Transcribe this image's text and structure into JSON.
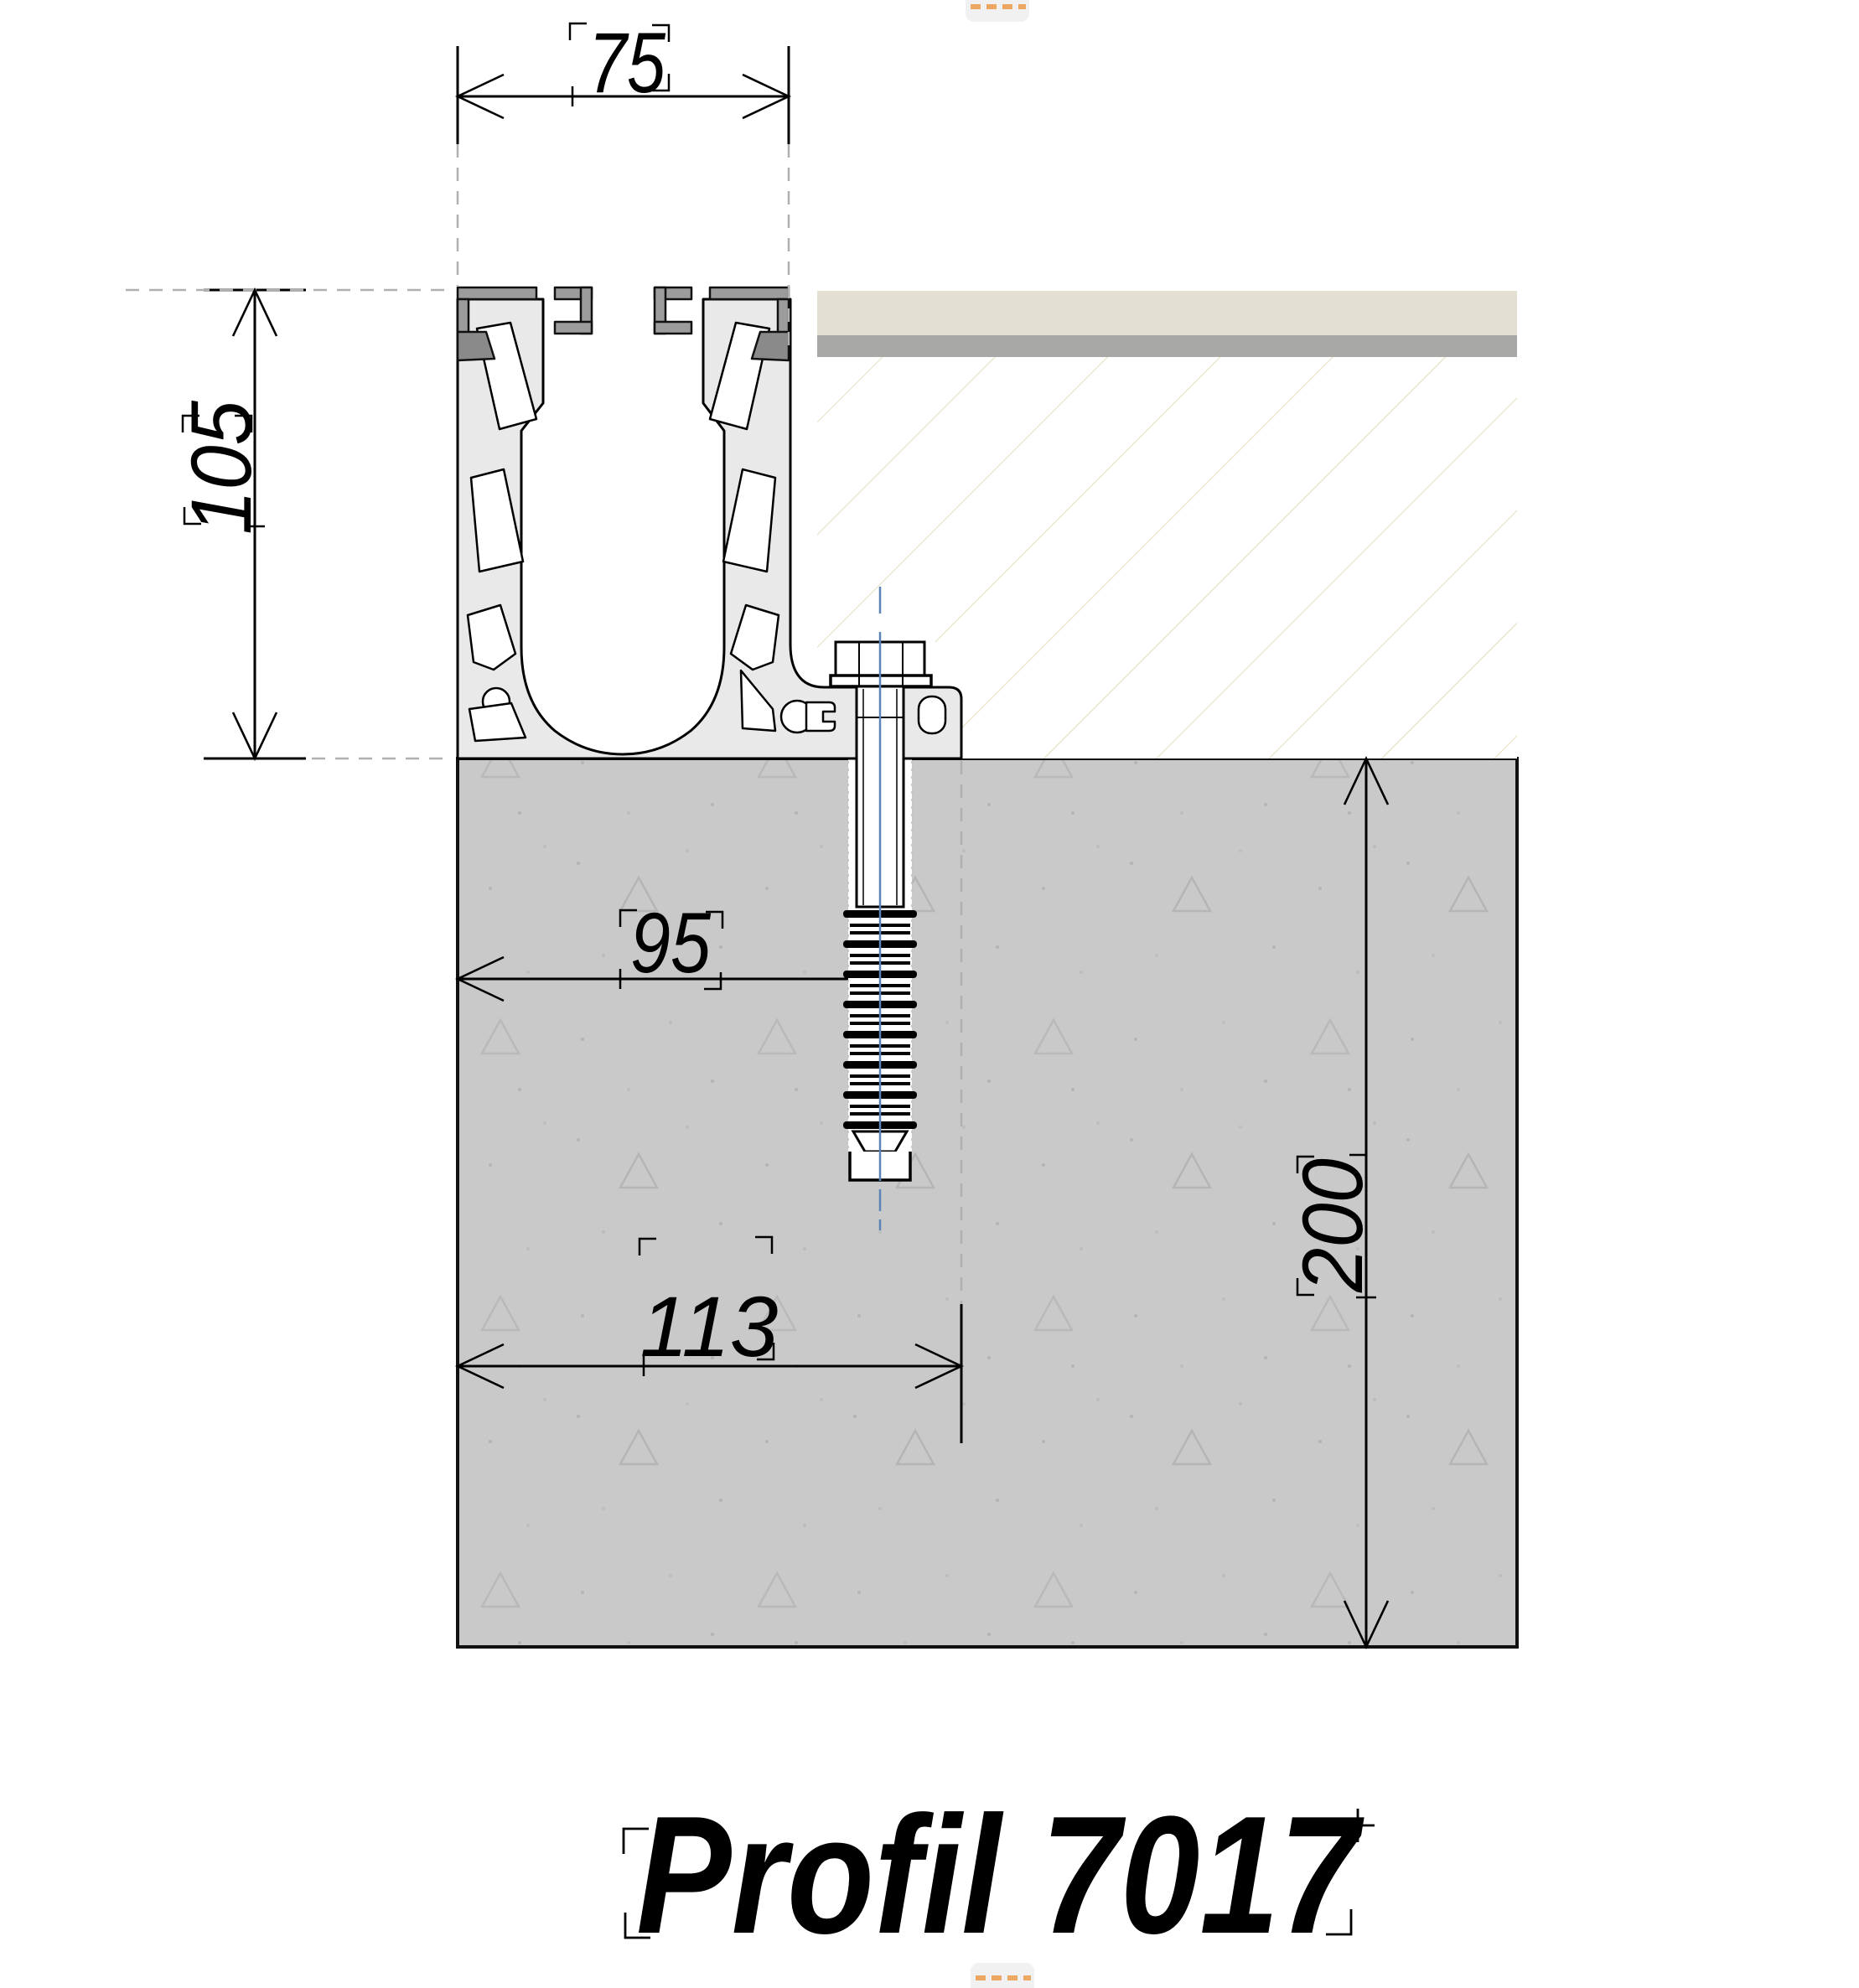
{
  "title": {
    "label": "Profil 7017"
  },
  "dims": {
    "top_width": "75",
    "profile_height": "105",
    "anchor_offset": "95",
    "base_width": "113",
    "embed_depth": "200"
  },
  "handles": {
    "top": "orange-dashed-drag-handle",
    "bottom": "orange-dashed-drag-handle"
  },
  "colors": {
    "concrete": "#c9c9c9",
    "slab_finish": "#e4dfd3",
    "slab_screed": "#a8a8a6",
    "hatch_line": "#e9e3cb",
    "profile_body": "#e9e9e9",
    "profile_gasket": "#9c9c9c",
    "profile_gasket_dark": "#8a8a8a",
    "centerline_blue": "#5b83b5",
    "handle_orange": "#eda763",
    "extension_dash_gray": "#b0b0b0"
  }
}
